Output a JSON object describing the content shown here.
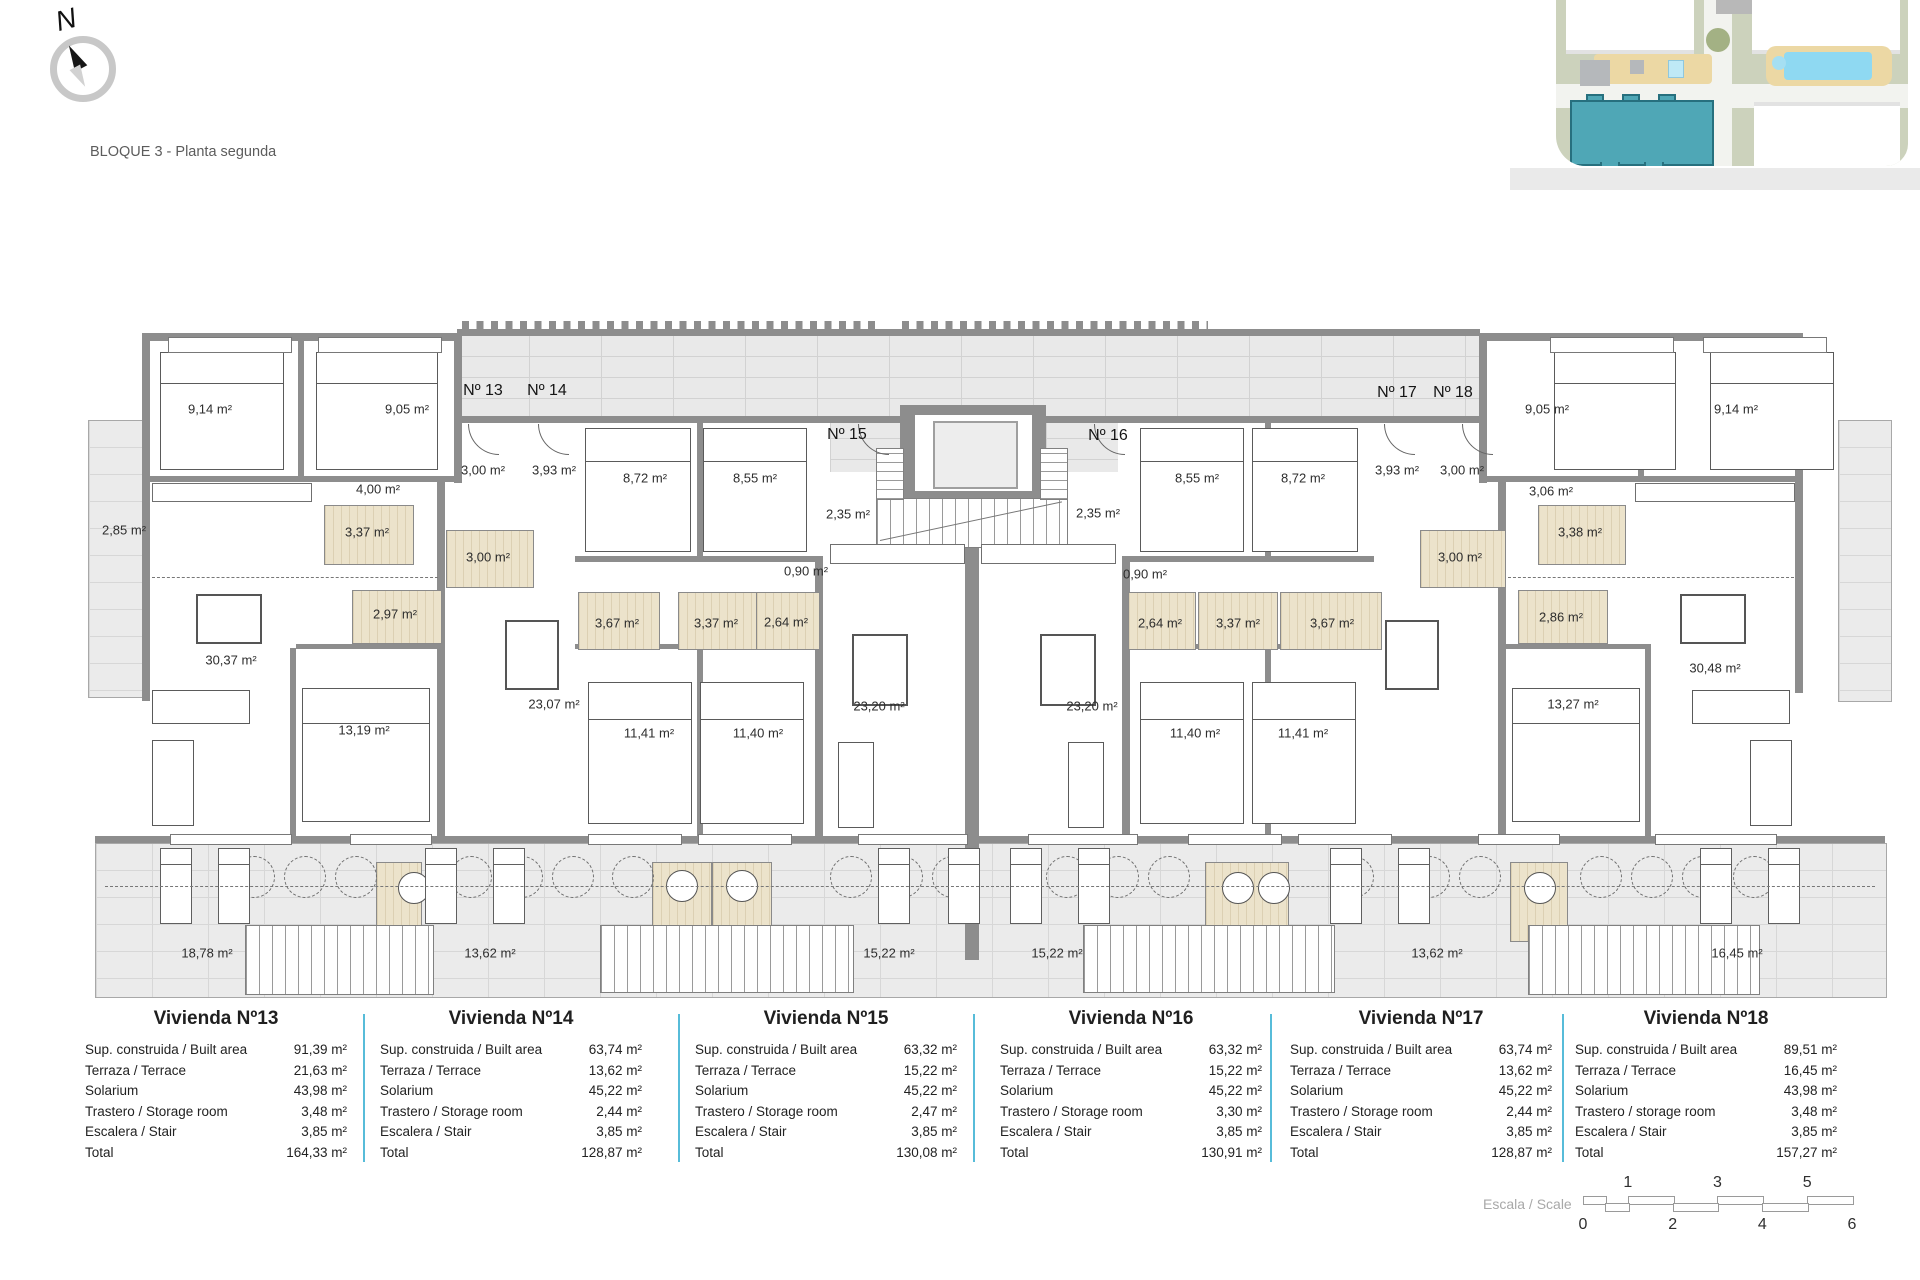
{
  "header": {
    "block_title": "BLOQUE 3 - Planta segunda",
    "north_label": "N"
  },
  "plan": {
    "unit_markers": [
      {
        "label": "Nº 13",
        "x": 483,
        "y": 391
      },
      {
        "label": "Nº 14",
        "x": 547,
        "y": 391
      },
      {
        "label": "Nº 15",
        "x": 847,
        "y": 435
      },
      {
        "label": "Nº 16",
        "x": 1108,
        "y": 436
      },
      {
        "label": "Nº 17",
        "x": 1397,
        "y": 393
      },
      {
        "label": "Nº 18",
        "x": 1453,
        "y": 393
      }
    ],
    "room_labels": [
      {
        "label": "9,14 m²",
        "x": 210,
        "y": 409
      },
      {
        "label": "9,05 m²",
        "x": 407,
        "y": 409
      },
      {
        "label": "3,00 m²",
        "x": 483,
        "y": 470
      },
      {
        "label": "3,93 m²",
        "x": 554,
        "y": 470
      },
      {
        "label": "8,72 m²",
        "x": 645,
        "y": 478
      },
      {
        "label": "8,55 m²",
        "x": 755,
        "y": 478
      },
      {
        "label": "2,85 m²",
        "x": 124,
        "y": 530
      },
      {
        "label": "4,00 m²",
        "x": 378,
        "y": 489
      },
      {
        "label": "3,37 m²",
        "x": 367,
        "y": 532
      },
      {
        "label": "3,00 m²",
        "x": 488,
        "y": 557
      },
      {
        "label": "2,97 m²",
        "x": 395,
        "y": 614
      },
      {
        "label": "30,37 m²",
        "x": 231,
        "y": 660
      },
      {
        "label": "13,19 m²",
        "x": 364,
        "y": 730
      },
      {
        "label": "18,78 m²",
        "x": 207,
        "y": 953
      },
      {
        "label": "3,67 m²",
        "x": 617,
        "y": 623
      },
      {
        "label": "3,37 m²",
        "x": 716,
        "y": 623
      },
      {
        "label": "2,64 m²",
        "x": 786,
        "y": 622
      },
      {
        "label": "0,90 m²",
        "x": 806,
        "y": 571
      },
      {
        "label": "23,07 m²",
        "x": 554,
        "y": 704
      },
      {
        "label": "11,41 m²",
        "x": 649,
        "y": 733
      },
      {
        "label": "11,40 m²",
        "x": 758,
        "y": 733
      },
      {
        "label": "13,62 m²",
        "x": 490,
        "y": 953
      },
      {
        "label": "2,35 m²",
        "x": 848,
        "y": 514
      },
      {
        "label": "23,20 m²",
        "x": 879,
        "y": 706
      },
      {
        "label": "15,22 m²",
        "x": 889,
        "y": 953
      },
      {
        "label": "2,35 m²",
        "x": 1098,
        "y": 513
      },
      {
        "label": "0,90 m²",
        "x": 1145,
        "y": 574
      },
      {
        "label": "23,20 m²",
        "x": 1092,
        "y": 706
      },
      {
        "label": "15,22 m²",
        "x": 1057,
        "y": 953
      },
      {
        "label": "8,55 m²",
        "x": 1197,
        "y": 478
      },
      {
        "label": "8,72 m²",
        "x": 1303,
        "y": 478
      },
      {
        "label": "2,64 m²",
        "x": 1160,
        "y": 623
      },
      {
        "label": "3,37 m²",
        "x": 1238,
        "y": 623
      },
      {
        "label": "3,67 m²",
        "x": 1332,
        "y": 623
      },
      {
        "label": "3,93 m²",
        "x": 1397,
        "y": 470
      },
      {
        "label": "3,00 m²",
        "x": 1462,
        "y": 470
      },
      {
        "label": "3,00 m²",
        "x": 1460,
        "y": 557
      },
      {
        "label": "3,06 m²",
        "x": 1551,
        "y": 491
      },
      {
        "label": "3,38 m²",
        "x": 1580,
        "y": 532
      },
      {
        "label": "2,86 m²",
        "x": 1561,
        "y": 617
      },
      {
        "label": "9,05 m²",
        "x": 1547,
        "y": 409
      },
      {
        "label": "9,14 m²",
        "x": 1736,
        "y": 409
      },
      {
        "label": "30,48 m²",
        "x": 1715,
        "y": 668
      },
      {
        "label": "13,27 m²",
        "x": 1573,
        "y": 704
      },
      {
        "label": "11,40 m²",
        "x": 1195,
        "y": 733
      },
      {
        "label": "11,41 m²",
        "x": 1303,
        "y": 733
      },
      {
        "label": "13,62 m²",
        "x": 1437,
        "y": 953
      },
      {
        "label": "16,45 m²",
        "x": 1737,
        "y": 953
      }
    ]
  },
  "tables": [
    {
      "title": "Vivienda Nº13",
      "rows": [
        {
          "label": "Sup. construida / Built area",
          "value": "91,39 m²"
        },
        {
          "label": "Terraza / Terrace",
          "value": "21,63 m²"
        },
        {
          "label": "Solarium",
          "value": "43,98 m²"
        },
        {
          "label": "Trastero / Storage room",
          "value": "3,48 m²"
        },
        {
          "label": "Escalera / Stair",
          "value": "3,85 m²"
        },
        {
          "label": "Total",
          "value": "164,33 m²"
        }
      ]
    },
    {
      "title": "Vivienda Nº14",
      "rows": [
        {
          "label": "Sup. construida / Built area",
          "value": "63,74 m²"
        },
        {
          "label": "Terraza / Terrace",
          "value": "13,62 m²"
        },
        {
          "label": "Solarium",
          "value": "45,22 m²"
        },
        {
          "label": "Trastero / Storage room",
          "value": "2,44 m²"
        },
        {
          "label": "Escalera / Stair",
          "value": "3,85 m²"
        },
        {
          "label": "Total",
          "value": "128,87 m²"
        }
      ]
    },
    {
      "title": "Vivienda Nº15",
      "rows": [
        {
          "label": "Sup. construida / Built area",
          "value": "63,32 m²"
        },
        {
          "label": "Terraza / Terrace",
          "value": "15,22 m²"
        },
        {
          "label": "Solarium",
          "value": "45,22 m²"
        },
        {
          "label": "Trastero / Storage room",
          "value": "2,47 m²"
        },
        {
          "label": "Escalera / Stair",
          "value": "3,85 m²"
        },
        {
          "label": "Total",
          "value": "130,08 m²"
        }
      ]
    },
    {
      "title": "Vivienda Nº16",
      "rows": [
        {
          "label": "Sup. construida / Built area",
          "value": "63,32 m²"
        },
        {
          "label": "Terraza / Terrace",
          "value": "15,22 m²"
        },
        {
          "label": "Solarium",
          "value": "45,22 m²"
        },
        {
          "label": "Trastero / Storage room",
          "value": "3,30 m²"
        },
        {
          "label": "Escalera / Stair",
          "value": "3,85 m²"
        },
        {
          "label": "Total",
          "value": "130,91 m²"
        }
      ]
    },
    {
      "title": "Vivienda Nº17",
      "rows": [
        {
          "label": "Sup. construida / Built area",
          "value": "63,74 m²"
        },
        {
          "label": "Terraza / Terrace",
          "value": "13,62 m²"
        },
        {
          "label": "Solarium",
          "value": "45,22 m²"
        },
        {
          "label": "Trastero / Storage room",
          "value": "2,44 m²"
        },
        {
          "label": "Escalera / Stair",
          "value": "3,85 m²"
        },
        {
          "label": "Total",
          "value": "128,87 m²"
        }
      ]
    },
    {
      "title": "Vivienda Nº18",
      "rows": [
        {
          "label": "Sup. construida / Built area",
          "value": "89,51 m²"
        },
        {
          "label": "Terraza / Terrace",
          "value": "16,45 m²"
        },
        {
          "label": "Solarium",
          "value": "43,98 m²"
        },
        {
          "label": "Trastero / storage room",
          "value": "3,48 m²"
        },
        {
          "label": "Escalera / Stair",
          "value": "3,85 m²"
        },
        {
          "label": "Total",
          "value": "157,27 m²"
        }
      ]
    }
  ],
  "scale_bar": {
    "label": "Escala / Scale",
    "ticks_top": [
      {
        "text": "1",
        "unit": 1
      },
      {
        "text": "3",
        "unit": 3
      },
      {
        "text": "5",
        "unit": 5
      }
    ],
    "ticks_bottom": [
      {
        "text": "0",
        "unit": 0
      },
      {
        "text": "2",
        "unit": 2
      },
      {
        "text": "4",
        "unit": 4
      },
      {
        "text": "6",
        "unit": 6
      }
    ]
  },
  "colors": {
    "accent_divider": "#57bcd9",
    "highlight_block": "#4fa7b6",
    "wall_gray": "#8d8d8d",
    "bath_fill": "#ece3cb",
    "site_green": "#ccd2bc",
    "deck_tan": "#ecd8a4",
    "pool_blue": "#8fd9f2"
  }
}
